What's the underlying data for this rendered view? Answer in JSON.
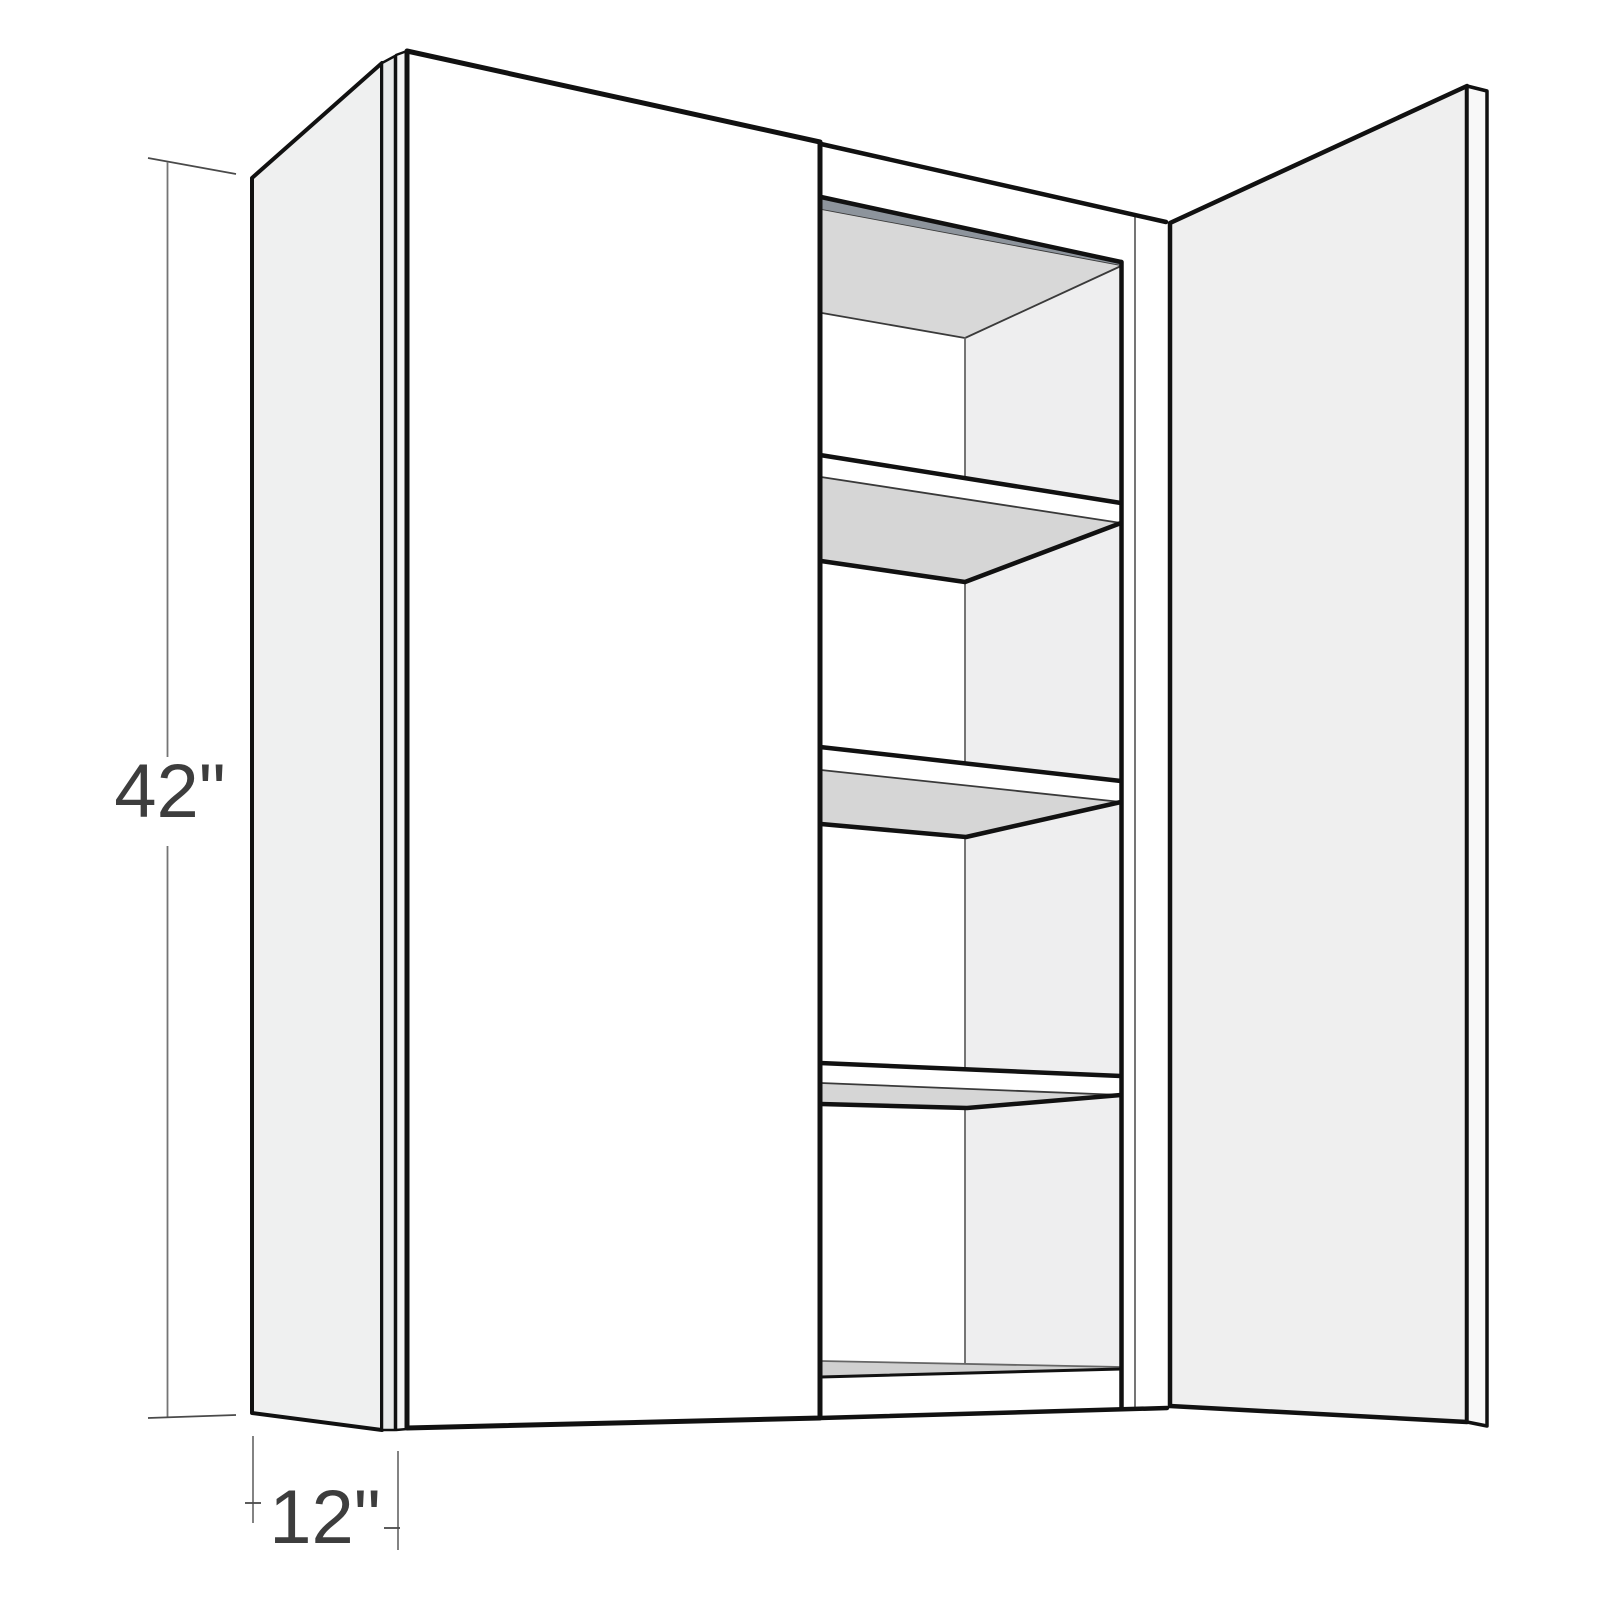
{
  "diagram": {
    "subject": "wall-cabinet-perspective-drawing",
    "doors_visible": 2,
    "open_door_side": "right",
    "shelves_visible": 3,
    "labels": {
      "height": "42\"",
      "depth": "12\""
    }
  },
  "colors": {
    "background": "#ffffff",
    "line": "#111111",
    "line-soft": "#3a3a3a",
    "line-faint": "#666666",
    "side-panel": "#eff0f0",
    "edge-strip": "#e9eaea",
    "edge-strip-light": "#f5f5f5",
    "door-closed": "#ffffff",
    "door-open": "#efefef",
    "door-edge": "#f8f8f8",
    "face-frame": "#ffffff",
    "ceiling-edge": "#8d949c",
    "ceiling-shade": "#d8d8d8",
    "wall-right": "#eeeeef",
    "shelf-shade": "#d6d6d6",
    "floor-shade": "#d0d0d0",
    "dim-line": "#757575",
    "dim-tick": "#4a4a4a",
    "dim-text": "#3d3d3d"
  }
}
